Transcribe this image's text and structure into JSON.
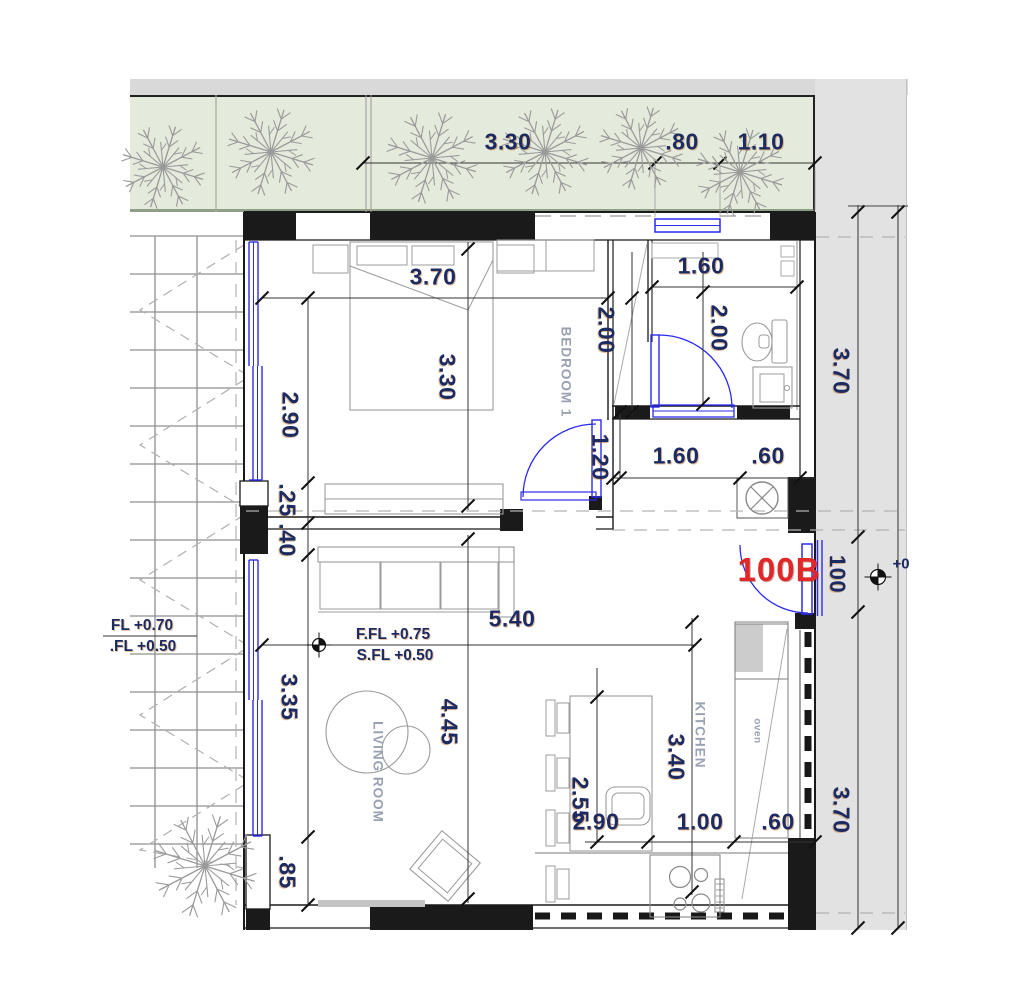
{
  "drawing": {
    "type": "apartment floor plan",
    "unit_label": "100B",
    "rooms": {
      "bedroom": "BEDROOM 1",
      "living": "LIVING ROOM",
      "kitchen": "KITCHEN",
      "oven": "oven"
    },
    "levels": {
      "living_finish_floor": "F.FL +0.75",
      "living_structural_floor": "S.FL +0.50",
      "terrace_finish_floor": "FL +0.70",
      "terrace_structural_floor": ".FL +0.50",
      "entry_level": "+0"
    },
    "dimensions": {
      "top_1": "3.30",
      "top_2": ".80",
      "top_3": "1.10",
      "bedroom_width": "3.70",
      "bedroom_left_height": "2.90",
      "bedroom_mid_height": "3.30",
      "bedroom_right_height": "2.00",
      "bath_width": "1.60",
      "bath_height": "2.00",
      "hall_height": "1.20",
      "hall_width_1": "1.60",
      "hall_width_2": ".60",
      "wall_a": ".25",
      "wall_b": ".40",
      "living_width": "5.40",
      "living_left_height": "3.35",
      "living_mid_height": "4.45",
      "left_lower": ".85",
      "dining_height": "2.55",
      "dining_width": "2.90",
      "kitchen_height": "3.40",
      "kitchen_width_1": "1.00",
      "kitchen_width_2": ".60",
      "right_top": "3.70",
      "right_bottom": "3.70",
      "entry_width": "100"
    },
    "icons": {
      "tree": "tree-icon",
      "shaft": "shaft-x-icon",
      "level_marker": "level-marker-icon"
    },
    "colors": {
      "window_door_blue": "#2b2bf0",
      "unit_label_red": "#e02828",
      "dimension_text": "#1d2b63",
      "room_text": "#99a1b3",
      "planter_green": "#e4ebdc",
      "corridor_gray": "#e2e2e2",
      "wall_black": "#1a1a1a"
    }
  }
}
